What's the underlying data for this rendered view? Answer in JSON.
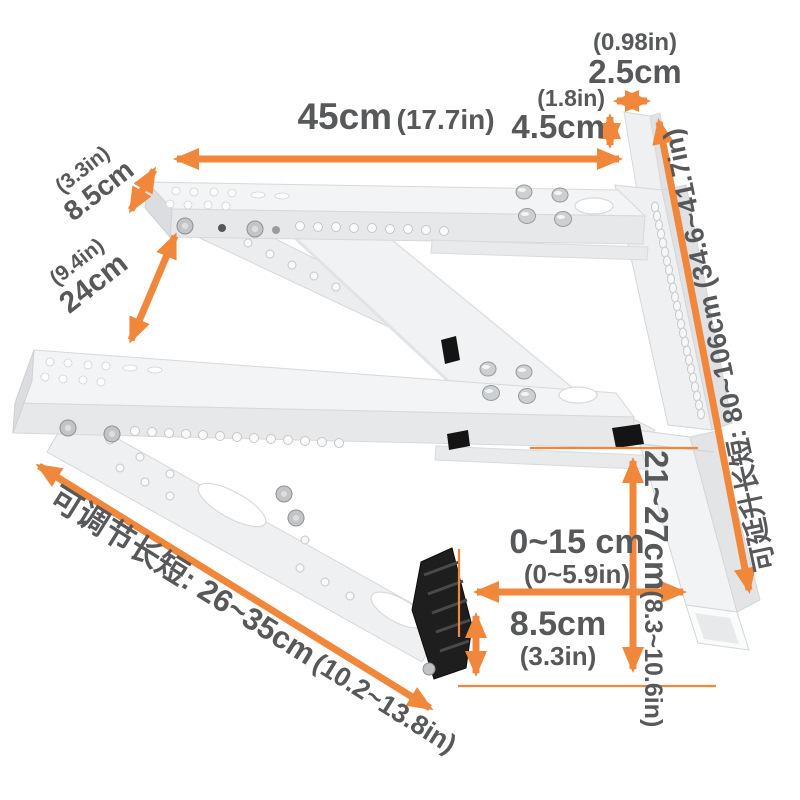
{
  "image_type": "product-dimension-diagram",
  "product": "air-conditioner-outdoor-unit-wall-bracket",
  "colors": {
    "annotation_orange": "#F0873B",
    "dimension_text_gray": "#57585A",
    "bracket_white": "#F3F4F5",
    "foot_black": "#1E1E1E",
    "background": "#FFFFFF"
  },
  "labels": {
    "top_width": {
      "inch": "(0.98in)",
      "cm": "2.5cm"
    },
    "top_height": {
      "inch": "(1.8in)",
      "cm": "4.5cm"
    },
    "top_length": {
      "cm": "45cm",
      "inch": "(17.7in)"
    },
    "plate_width": {
      "inch": "(3.3in)",
      "cm": "8.5cm"
    },
    "arm_gap": {
      "inch": "(9.4in)",
      "cm": "24cm"
    },
    "rail_length": {
      "text": "可延升长短: 80~106cm (34.6~41.7in)"
    },
    "foot_gap": {
      "cm": "0~15 cm",
      "inch": "(0~5.9in)"
    },
    "foot_height": {
      "cm": "8.5cm",
      "inch": "(3.3in)"
    },
    "drop_height": {
      "cm": "21~27cm",
      "inch": "(8.3~10.6in)"
    },
    "brace_length": {
      "cm": "可调节长短: 26~35cm",
      "inch": "(10.2~13.8in)"
    }
  }
}
